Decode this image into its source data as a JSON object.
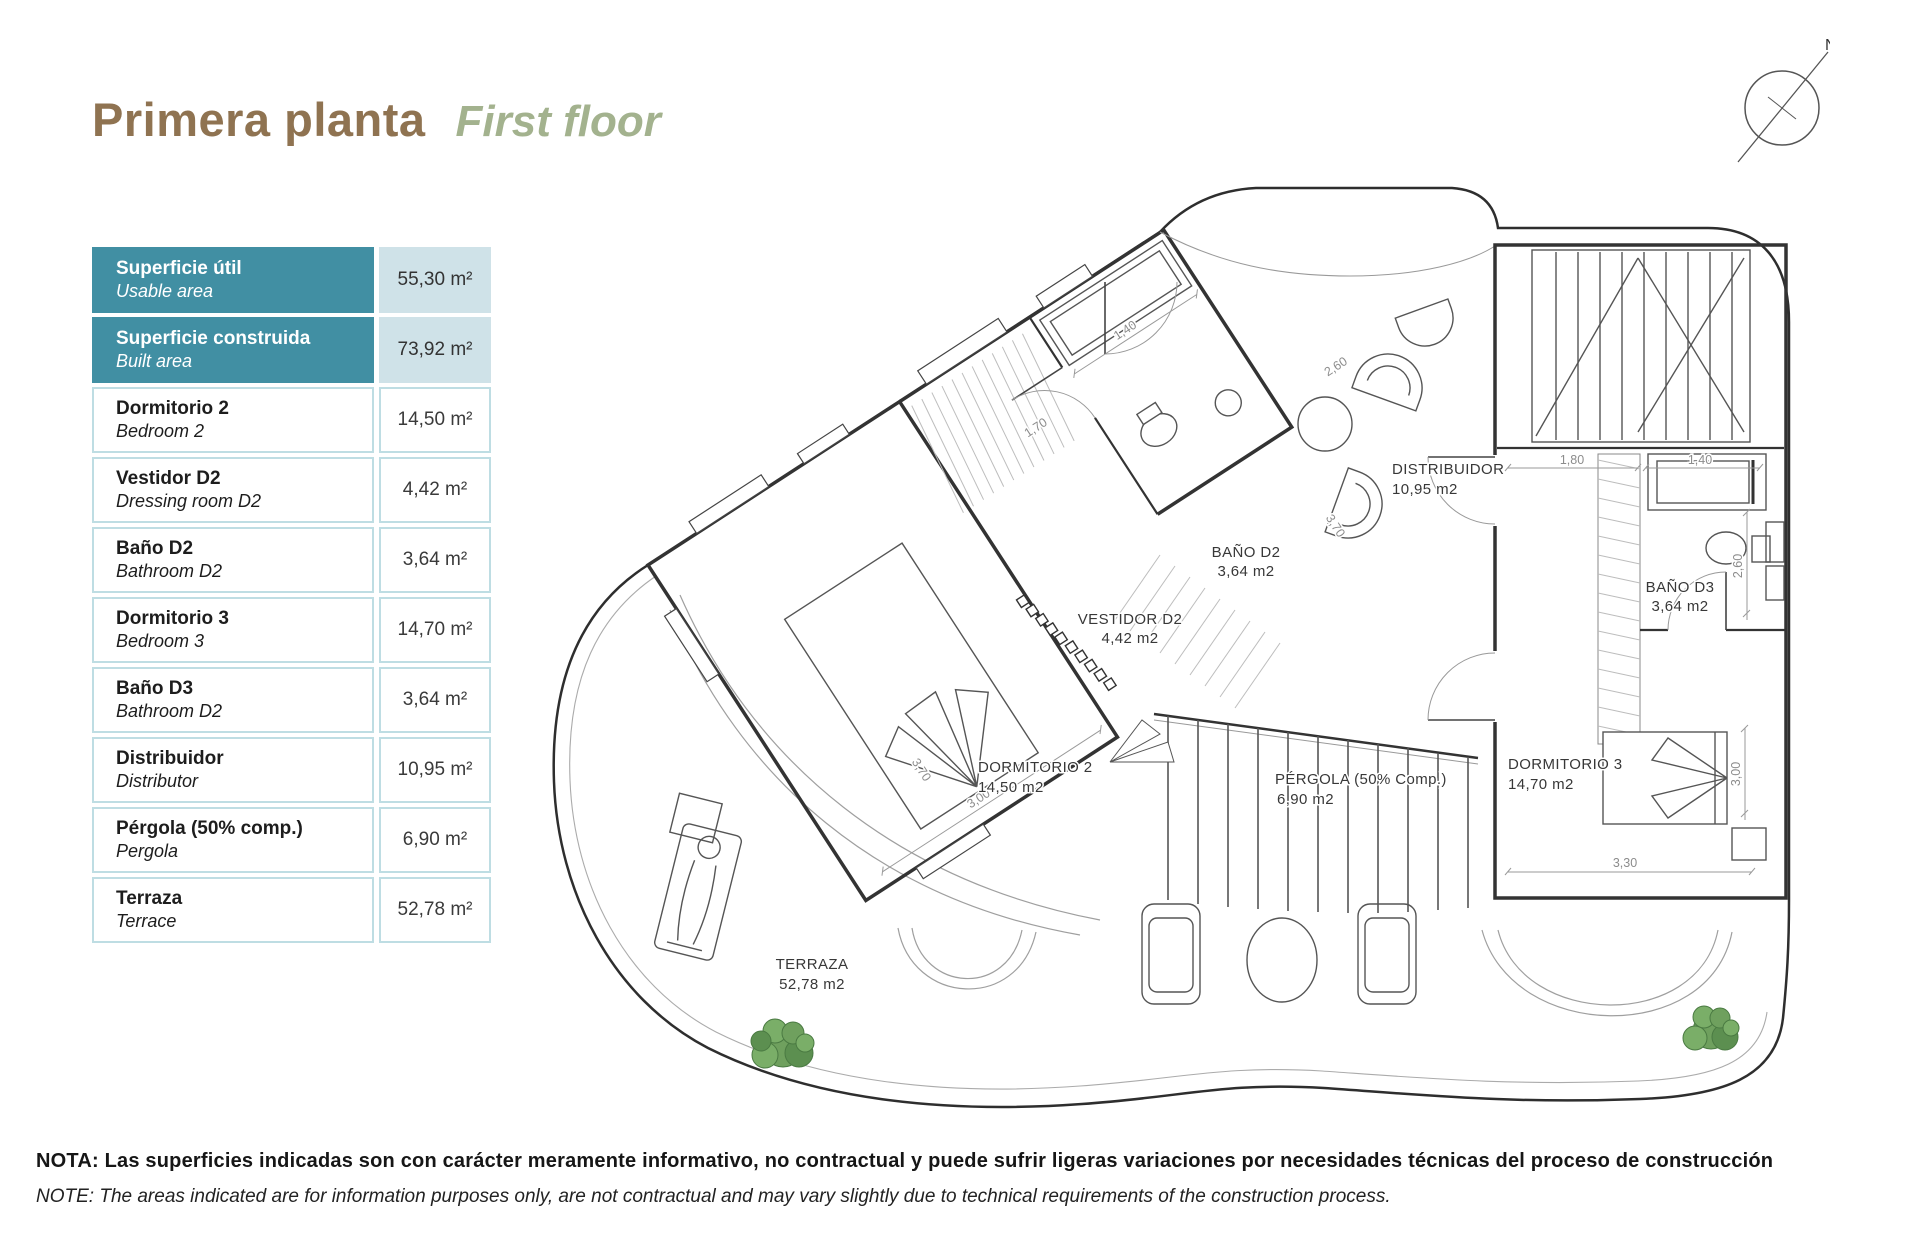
{
  "title": {
    "primary": "Primera planta",
    "secondary": "First floor"
  },
  "compass": {
    "north_label": "N"
  },
  "area_table": {
    "rows": [
      {
        "name_es": "Superficie útil",
        "name_en": "Usable area",
        "value": "55,30 m²"
      },
      {
        "name_es": "Superficie construida",
        "name_en": "Built area",
        "value": "73,92 m²"
      },
      {
        "name_es": "Dormitorio 2",
        "name_en": "Bedroom 2",
        "value": "14,50 m²"
      },
      {
        "name_es": "Vestidor D2",
        "name_en": "Dressing room D2",
        "value": "4,42 m²"
      },
      {
        "name_es": "Baño D2",
        "name_en": "Bathroom D2",
        "value": "3,64 m²"
      },
      {
        "name_es": "Dormitorio 3",
        "name_en": "Bedroom 3",
        "value": "14,70 m²"
      },
      {
        "name_es": "Baño D3",
        "name_en": "Bathroom D2",
        "value": "3,64 m²"
      },
      {
        "name_es": "Distribuidor",
        "name_en": "Distributor",
        "value": "10,95 m²"
      },
      {
        "name_es": "Pérgola (50% comp.)",
        "name_en": "Pergola",
        "value": "6,90 m²"
      },
      {
        "name_es": "Terraza",
        "name_en": "Terrace",
        "value": "52,78 m²"
      }
    ]
  },
  "plan": {
    "rooms": [
      {
        "name": "DISTRIBUIDOR",
        "area": "10,95 m2"
      },
      {
        "name": "BAÑO D2",
        "area": "3,64 m2"
      },
      {
        "name": "VESTIDOR D2",
        "area": "4,42 m2"
      },
      {
        "name": "DORMITORIO 2",
        "area": "14,50 m2"
      },
      {
        "name": "PÉRGOLA (50% Comp.)",
        "area": "6,90 m2"
      },
      {
        "name": "DORMITORIO 3",
        "area": "14,70 m2"
      },
      {
        "name": "BAÑO D3",
        "area": "3,64 m2"
      },
      {
        "name": "TERRAZA",
        "area": "52,78 m2"
      }
    ],
    "dimensions": [
      "2,60",
      "1,40",
      "1,70",
      "3,00",
      "3,70",
      "3,70",
      "1,80",
      "1,40",
      "2,60",
      "3,00",
      "3,30"
    ]
  },
  "notes": {
    "es": "NOTA: Las superficies indicadas son con carácter meramente informativo, no contractual y puede sufrir ligeras variaciones por necesidades técnicas del proceso de construcción",
    "en": "NOTE: The areas indicated are for information purposes only, are not contractual and may vary slightly due to technical requirements of the construction process."
  },
  "colors": {
    "teal": "#418FA3",
    "teal_light": "#CFE2E8",
    "cell_border": "#BEDDE3",
    "brown": "#8F7351",
    "sage": "#A3B28E"
  }
}
